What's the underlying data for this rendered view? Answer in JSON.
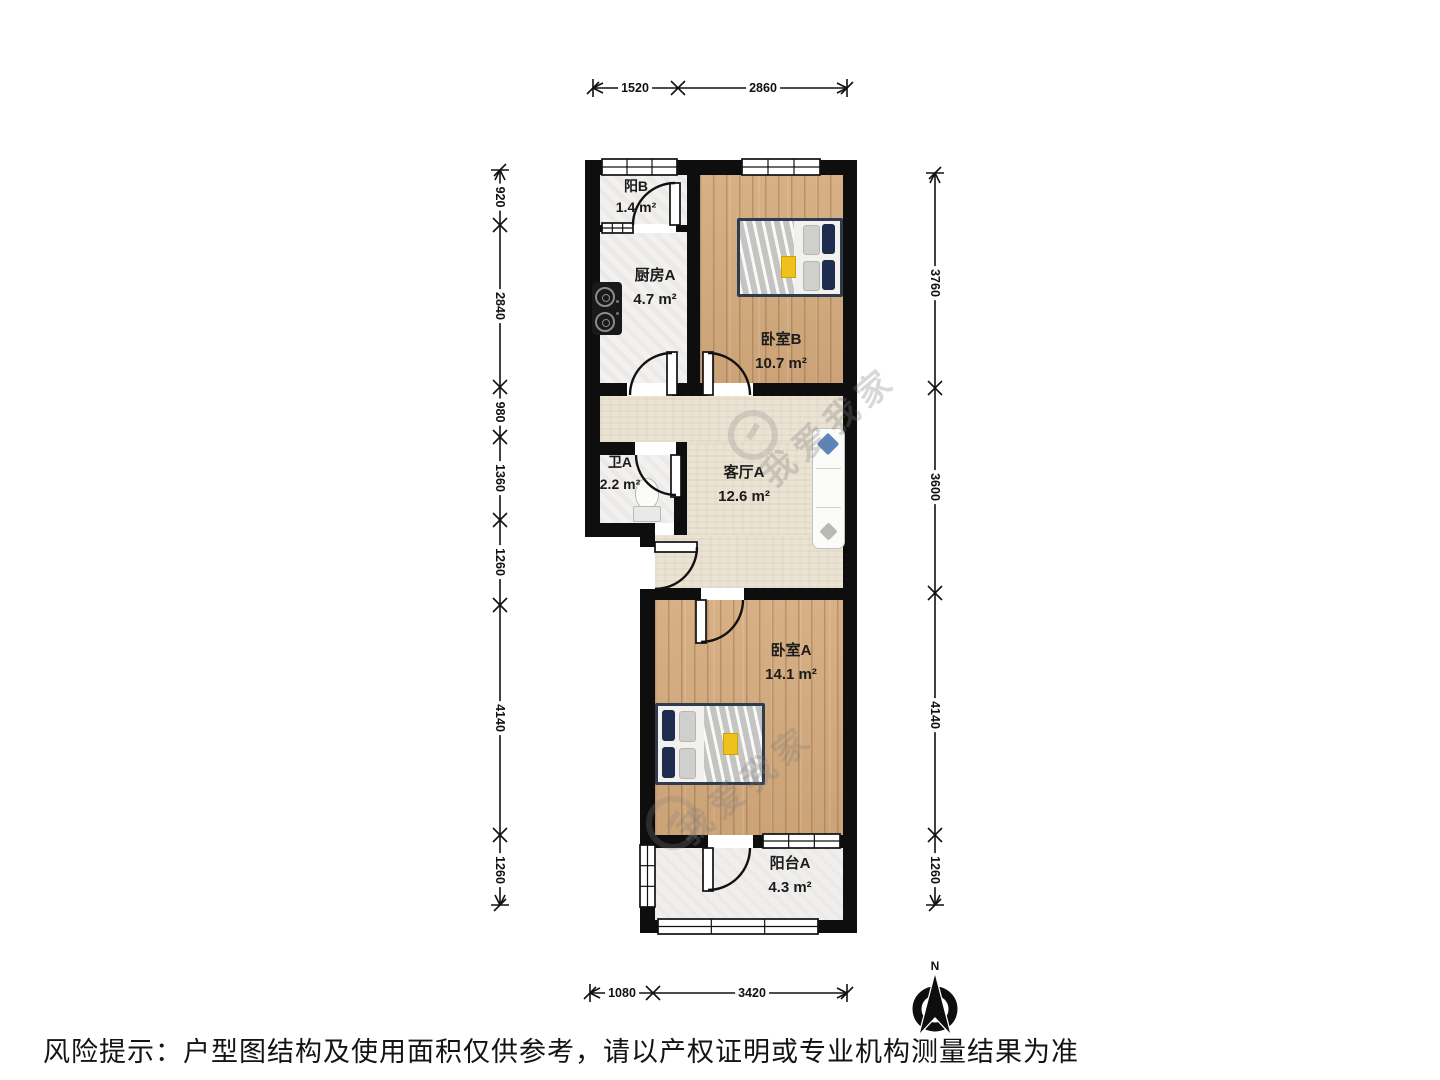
{
  "rooms": [
    {
      "name": "阳B",
      "area": "1.4 m²"
    },
    {
      "name": "厨房A",
      "area": "4.7 m²"
    },
    {
      "name": "卧室B",
      "area": "10.7 m²"
    },
    {
      "name": "卫A",
      "area": "2.2 m²"
    },
    {
      "name": "客厅A",
      "area": "12.6 m²"
    },
    {
      "name": "卧室A",
      "area": "14.1 m²"
    },
    {
      "name": "阳台A",
      "area": "4.3 m²"
    }
  ],
  "dimensions": {
    "top": [
      "1520",
      "2860"
    ],
    "left": [
      "920",
      "2840",
      "980",
      "1360",
      "1260",
      "4140",
      "1260"
    ],
    "right": [
      "3760",
      "3600",
      "4140",
      "1260"
    ],
    "bottom": [
      "1080",
      "3420"
    ]
  },
  "compass": {
    "label": "N"
  },
  "watermark": {
    "text": "我爱我家"
  },
  "disclaimer": "风险提示：户型图结构及使用面积仅供参考，请以产权证明或专业机构测量结果为准",
  "colors": {
    "wall": "#0e0e0e",
    "wood_floor": "#d2ab7f",
    "living_floor": "#ebe4d5",
    "marble_floor": "#f2f1ef",
    "pillow_navy": "#1e2c4f",
    "sofa_pillow_blue": "#5b84b8",
    "book_yellow": "#f0c01d"
  }
}
